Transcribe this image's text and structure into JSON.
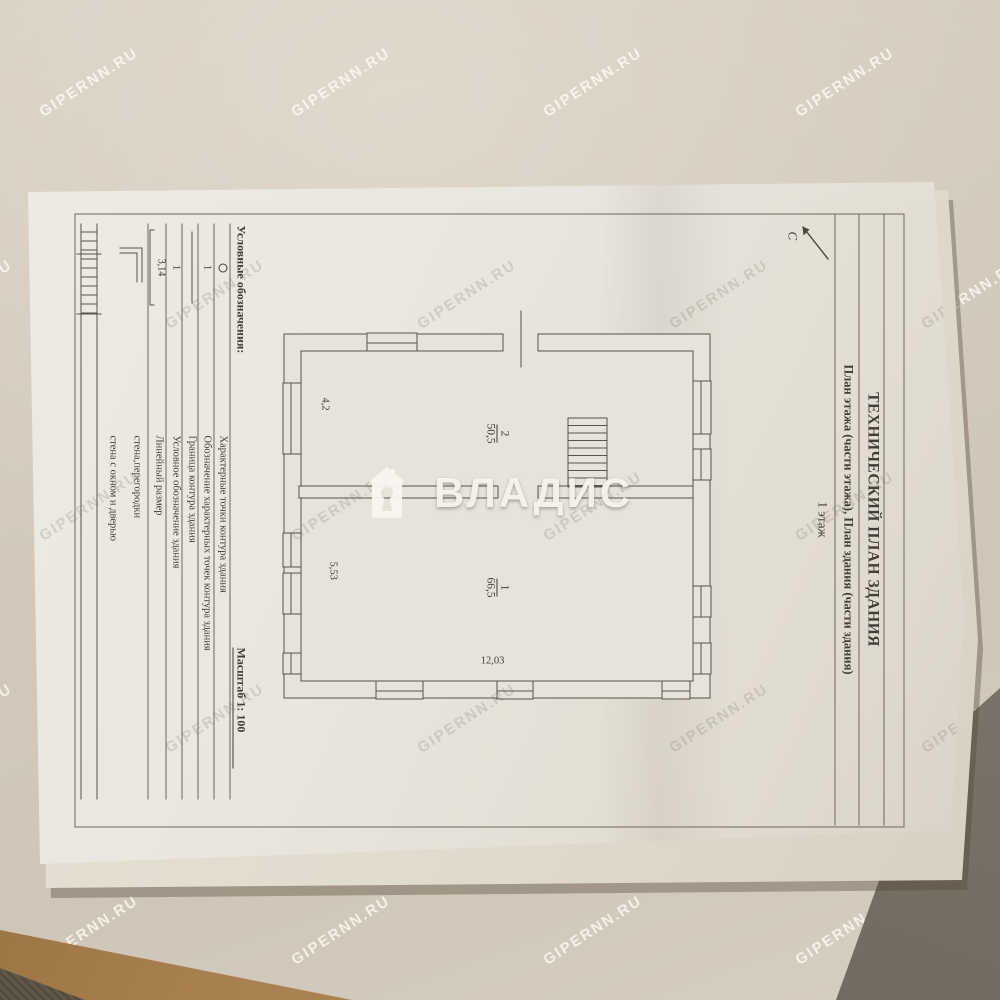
{
  "photo": {
    "watermark_text": "GIPERNN.RU",
    "brand_watermark": "ВЛАДИС"
  },
  "document": {
    "title": "ТЕХНИЧЕСКИЙ ПЛАН ЗДАНИЯ",
    "subtitle": "План этажа (части этажа), План здания (части здания)",
    "floor_label": "1 этаж",
    "north_label": "С",
    "plan": {
      "rooms": [
        {
          "number": "2",
          "area": "50,5"
        },
        {
          "number": "1",
          "area": "66,5"
        }
      ],
      "dimensions": {
        "bottom_left": "4,2",
        "bottom_right": "5,53",
        "right_side": "12,03"
      }
    },
    "legend": {
      "header": "Условные обозначения:",
      "scale_label": "Масштаб 1: 100",
      "rows": [
        {
          "symbol": "о",
          "label": "Характерные точки контура здания"
        },
        {
          "symbol": "1",
          "label": "Обозначение характерных точек контура здания"
        },
        {
          "symbol": "",
          "label": "Граница контура здания"
        },
        {
          "symbol": "1",
          "label": "Условное обозначение здания"
        },
        {
          "symbol": "3,14",
          "label": "Линейный размер"
        },
        {
          "symbol": "",
          "label": "стена,перегородки"
        },
        {
          "symbol": "",
          "label": "стена с окном и дверью"
        }
      ]
    }
  },
  "colors": {
    "background_beige": "#d3cabc",
    "paper_white": "#e9e6df",
    "ink": "#57524a",
    "wood_strip": "#a87f4e",
    "dark_wedge": "#7b7468",
    "watermark_on_bg": "#fffcf4",
    "watermark_on_paper": "#686258",
    "brand_white": "#f8f6f0"
  }
}
